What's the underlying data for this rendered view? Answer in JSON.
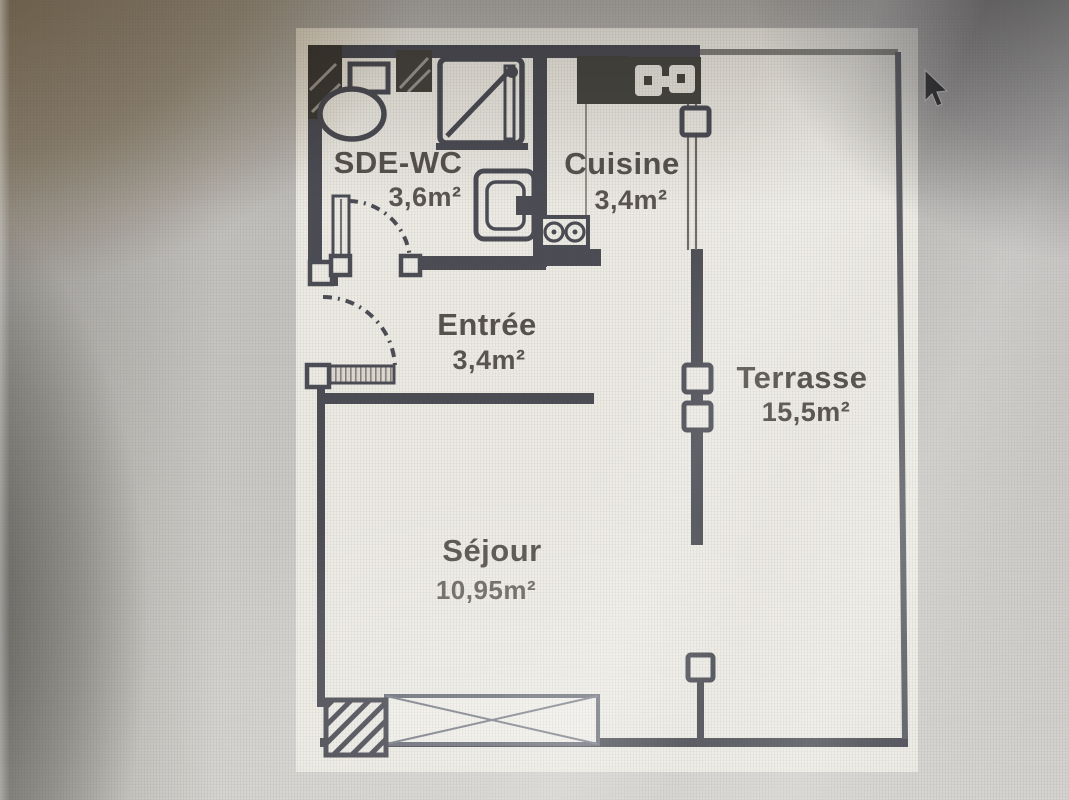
{
  "photo": {
    "cursor": {
      "type": "arrow-pointer"
    }
  },
  "floor_plan": {
    "rooms": [
      {
        "id": "sde-wc",
        "name": "SDE-WC",
        "area": "3,6m²"
      },
      {
        "id": "cuisine",
        "name": "Cuisine",
        "area": "3,4m²"
      },
      {
        "id": "entree",
        "name": "Entrée",
        "area": "3,4m²"
      },
      {
        "id": "terrasse",
        "name": "Terrasse",
        "area": "15,5m²"
      },
      {
        "id": "sejour",
        "name": "Séjour",
        "area": "10,95m²"
      }
    ],
    "fixtures": [
      "toilet-icon",
      "shower-icon",
      "washbasin-icon",
      "kitchen-sink-icon",
      "kitchen-counter-icon",
      "stove-icon",
      "door-swing-arc",
      "window-symbol",
      "hatched-column-symbol",
      "railing-post-symbol"
    ],
    "colors": {
      "wall": "#4b4c54",
      "paper": "#eceae3",
      "background": "#c2c0bd",
      "label": "#57524d",
      "shadow_tint": "#8a7a5e"
    }
  }
}
